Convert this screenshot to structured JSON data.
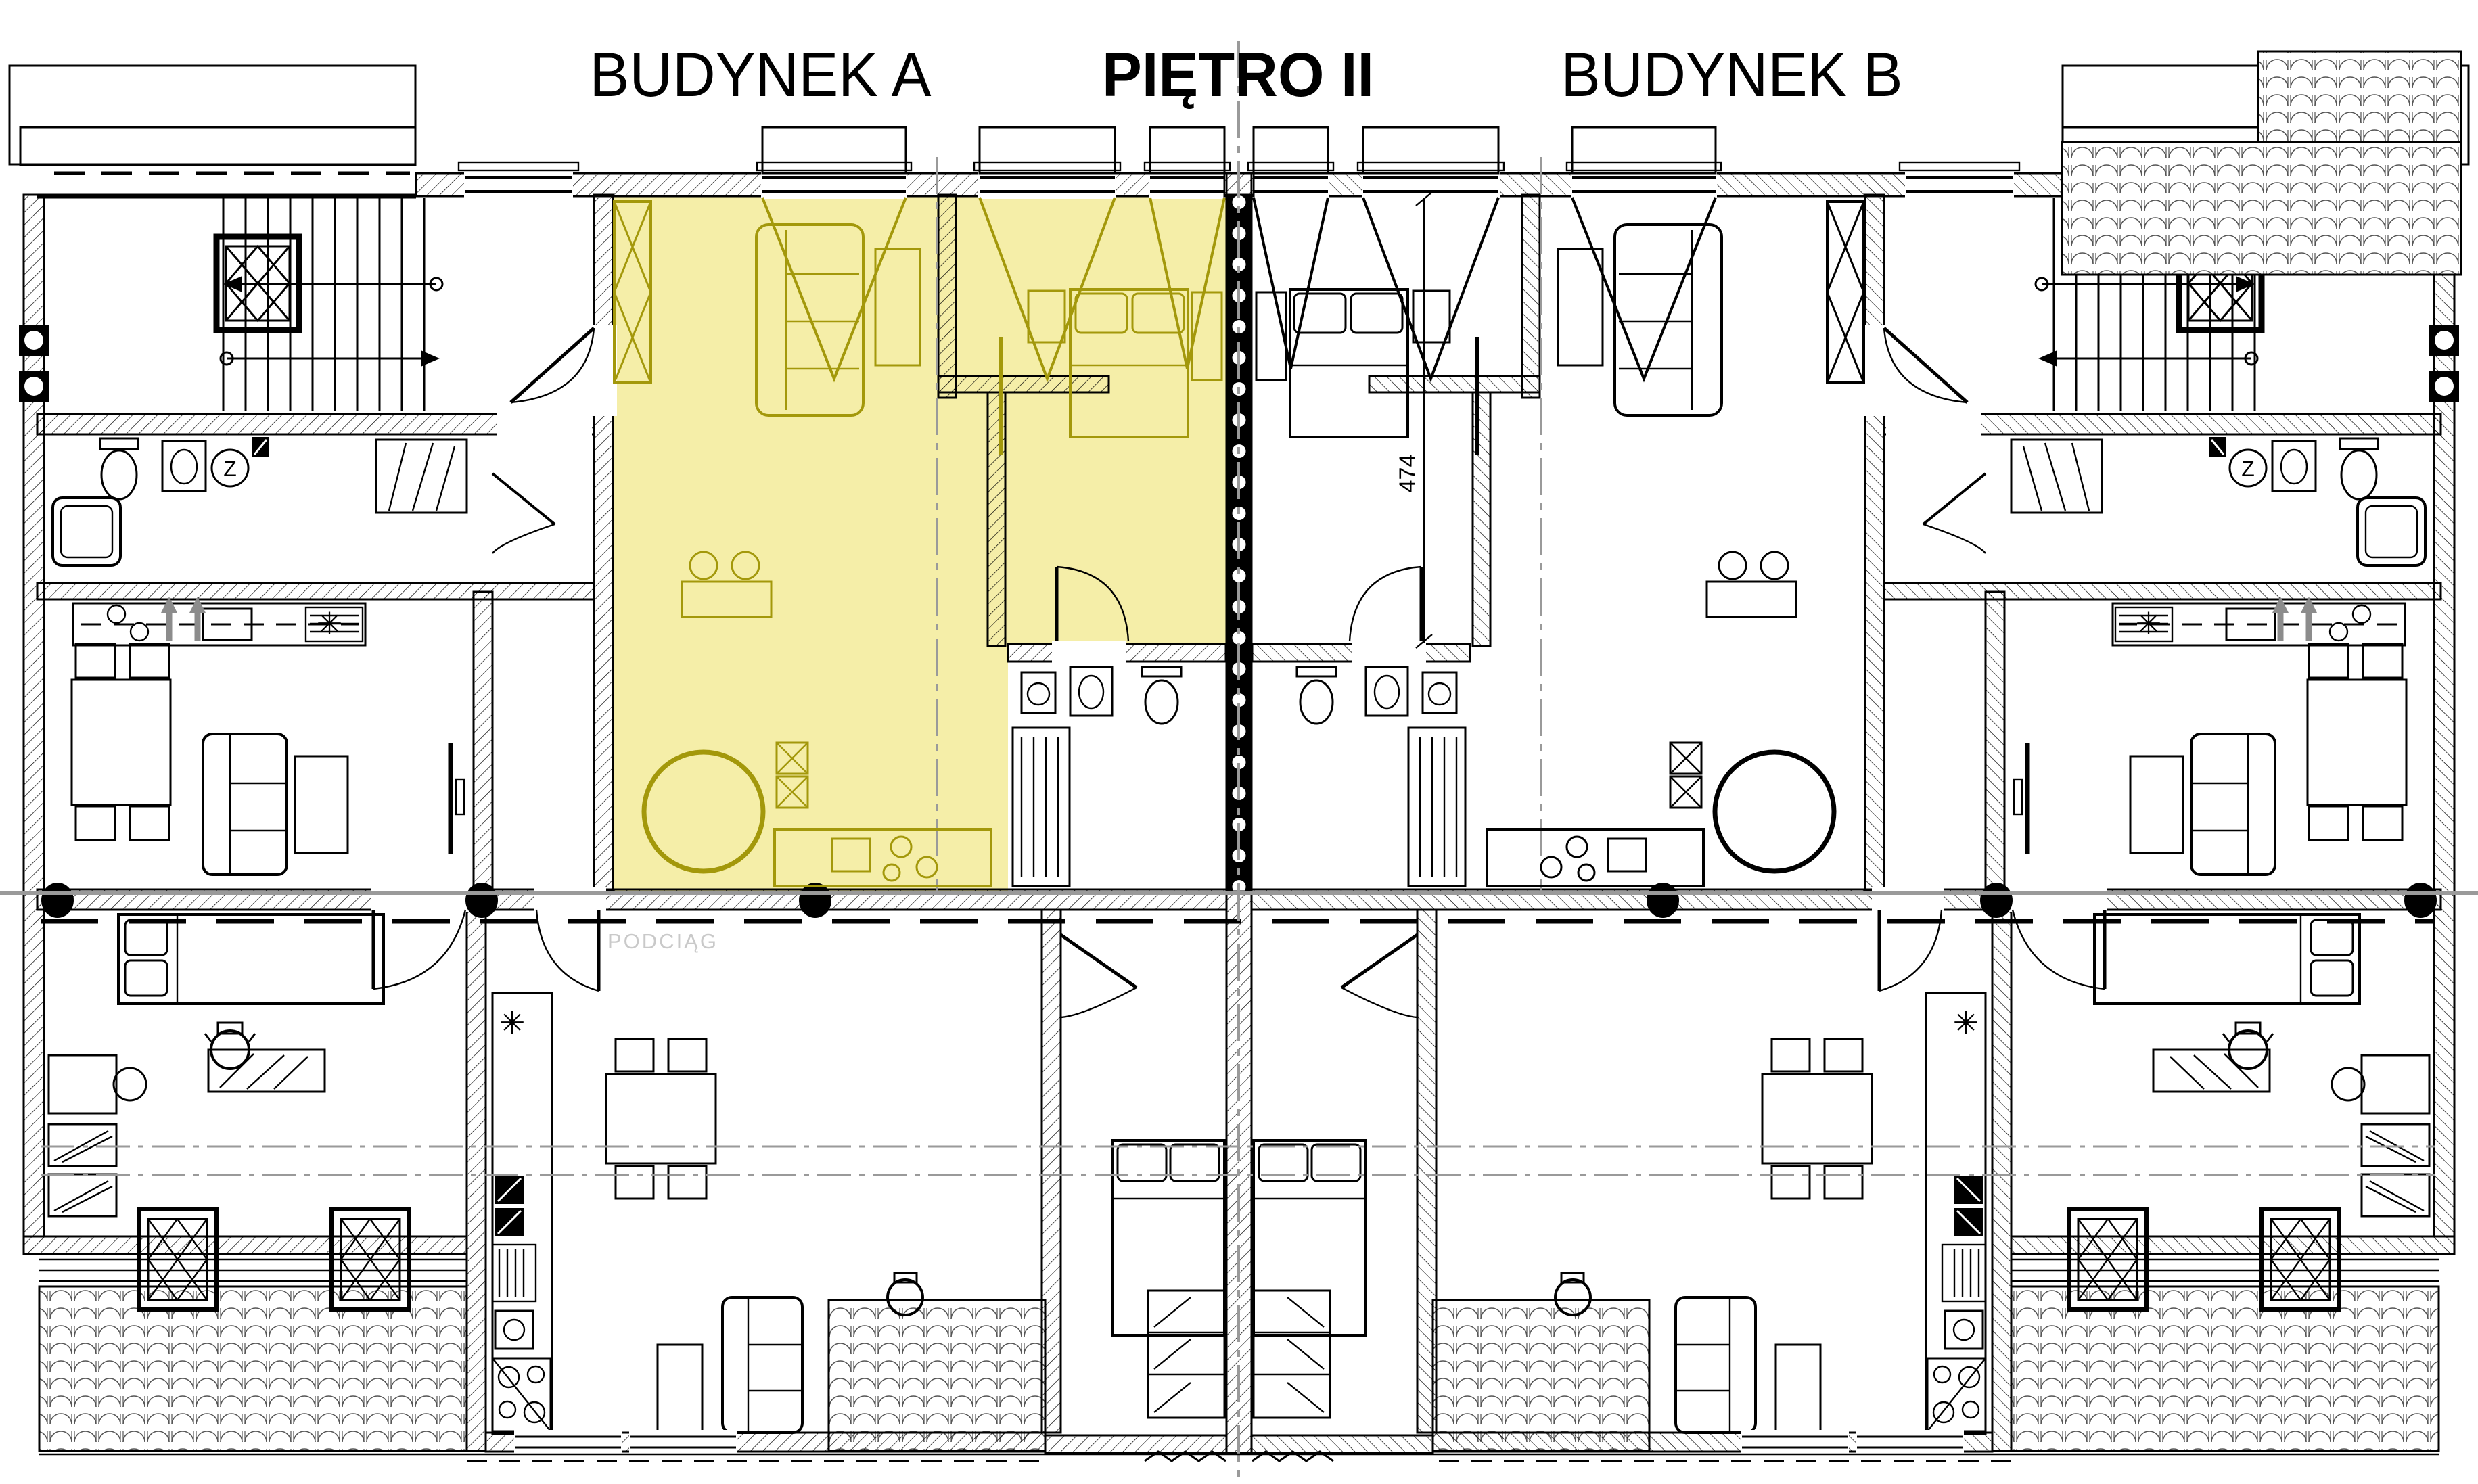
{
  "document": {
    "kind": "architectural-floor-plan"
  },
  "titles": {
    "building_a": "BUDYNEK A",
    "floor": "PIĘTRO II",
    "building_b": "BUDYNEK B"
  },
  "annotations": {
    "beam_label": "PODCIĄG",
    "dim_width": "474"
  },
  "symbols": {
    "boiler": "✳",
    "z_fixture": "Z"
  },
  "icons": {
    "elevator": "elevator-shaft-diamond",
    "stairs": "stair-treads",
    "toilet": "toilet-icon",
    "sink": "sink-icon",
    "shower": "shower-icon",
    "bed": "double-bed-icon",
    "sofa": "sofa-icon",
    "dining": "table-with-chairs-icon",
    "stove": "stove-burners-icon",
    "wardrobe": "wardrobe-x-icon",
    "plant": "pot-icon",
    "tv": "tv-icon"
  },
  "colors": {
    "paper": "#FFFFFF",
    "wall": "#000000",
    "highlight_fill": "#F5EEA8",
    "highlight_stroke": "#A3980B",
    "section_line": "#9A9A9A",
    "beam_label_text": "#C9C9C9",
    "gray_arrow": "#8C8C8C",
    "tile_stroke": "#555555"
  }
}
